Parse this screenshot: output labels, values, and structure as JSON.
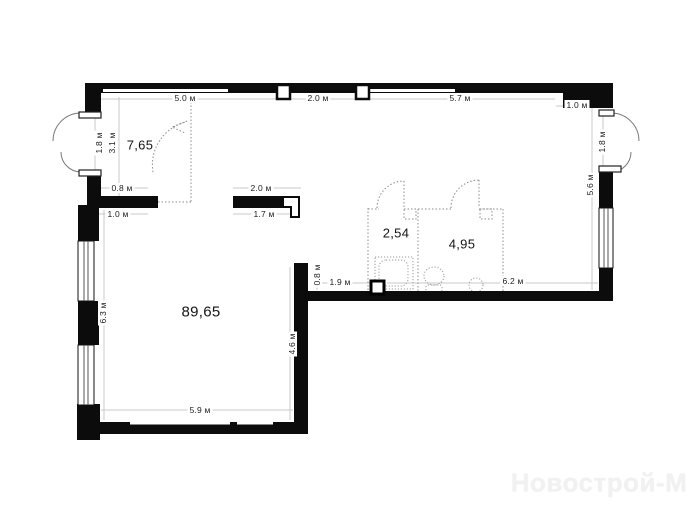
{
  "plan": {
    "watermark": "Новострой-М",
    "rooms": {
      "hall": {
        "area": "7,65"
      },
      "bath_small": {
        "area": "2,54"
      },
      "bath_large": {
        "area": "4,95"
      },
      "main": {
        "area": "89,65"
      }
    },
    "dimensions": {
      "top_1": "5.0 м",
      "top_2": "2.0 м",
      "top_3": "5.7 м",
      "top_4": "1.0 м",
      "left_door": "1.8 м",
      "left_hall": "3.1 м",
      "step_1": "0.8 м",
      "step_2": "1.0 м",
      "left_main": "6.3 м",
      "stub_top": "2.0 м",
      "stub_bottom": "1.7 м",
      "inner_wall": "0.8 м",
      "inner_bottom_1": "1.9 м",
      "inner_bottom_2": "6.2 м",
      "right_door": "1.8 м",
      "right_wall": "5.6 м",
      "main_right": "4.6 м",
      "main_bottom": "5.9 м"
    },
    "colors": {
      "wall": "#0c0c0c",
      "dim_line": "#c9c9c9",
      "dashed_line": "#8c8c8c",
      "text": "#1c1c1c",
      "watermark": "#f1f1f1"
    }
  }
}
